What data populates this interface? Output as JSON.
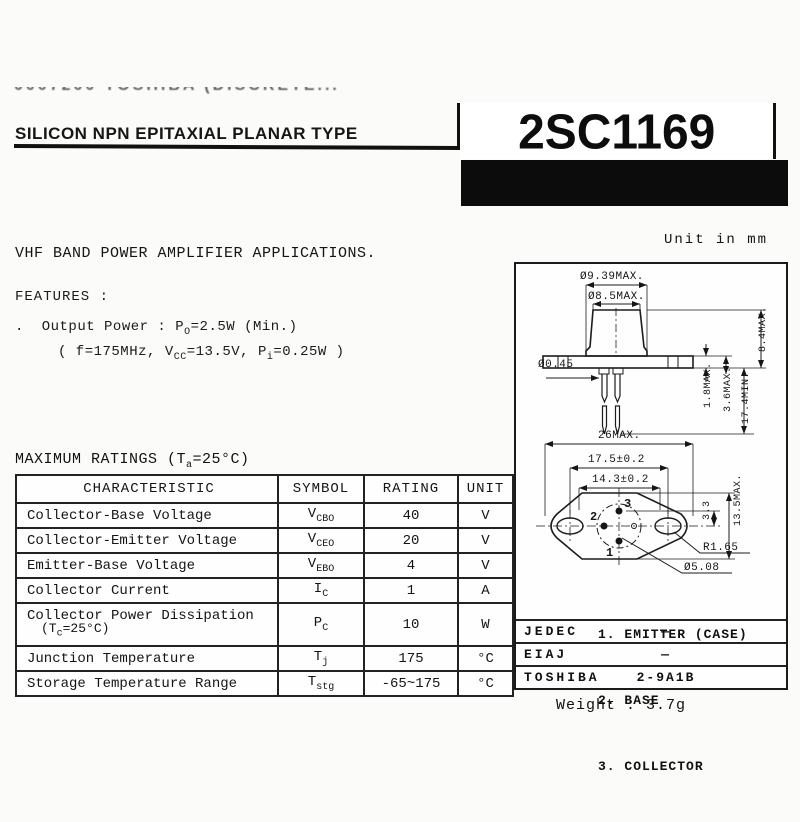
{
  "header": {
    "faded_top_line": "0007200 TOSHIBA (DISCRETE...",
    "type_line": "SILICON NPN EPITAXIAL PLANAR TYPE",
    "part_number": "2SC1169"
  },
  "application": "VHF BAND POWER AMPLIFIER APPLICATIONS.",
  "features": {
    "heading": "FEATURES :",
    "bullet": ".",
    "output_power_pre": "Output Power :  P",
    "output_power_sub": "O",
    "output_power_post": "=2.5W (Min.)",
    "cond_pre": "( f=175MHz, V",
    "cond_sub1": "CC",
    "cond_mid": "=13.5V, P",
    "cond_sub2": "i",
    "cond_post": "=0.25W )"
  },
  "max_ratings": {
    "title_pre": "MAXIMUM RATINGS (T",
    "title_sub": "a",
    "title_post": "=25°C)",
    "columns": [
      "CHARACTERISTIC",
      "SYMBOL",
      "RATING",
      "UNIT"
    ],
    "rows": [
      {
        "characteristic": "Collector-Base Voltage",
        "symbol_base": "V",
        "symbol_sub": "CBO",
        "rating": "40",
        "unit": "V"
      },
      {
        "characteristic": "Collector-Emitter Voltage",
        "symbol_base": "V",
        "symbol_sub": "CEO",
        "rating": "20",
        "unit": "V"
      },
      {
        "characteristic": "Emitter-Base Voltage",
        "symbol_base": "V",
        "symbol_sub": "EBO",
        "rating": "4",
        "unit": "V"
      },
      {
        "characteristic": "Collector Current",
        "symbol_base": "I",
        "symbol_sub": "C",
        "rating": "1",
        "unit": "A"
      },
      {
        "characteristic": "Collector Power Dissipation",
        "char2_pre": "(T",
        "char2_sub": "c",
        "char2_post": "=25°C)",
        "symbol_base": "P",
        "symbol_sub": "C",
        "rating": "10",
        "unit": "W"
      },
      {
        "characteristic": "Junction Temperature",
        "symbol_base": "T",
        "symbol_sub": "j",
        "rating": "175",
        "unit": "°C"
      },
      {
        "characteristic": "Storage Temperature Range",
        "symbol_base": "T",
        "symbol_sub": "stg",
        "rating": "-65~175",
        "unit": "°C"
      }
    ]
  },
  "outline": {
    "unit_note": "Unit in mm",
    "dimensions": {
      "cap_base_dia": "Ø9.39MAX.",
      "cap_top_dia": "Ø8.5MAX.",
      "lead_dia": "Ø0.45",
      "flange_thickness": "1.8MAX.",
      "seat_height": "3.6MAX.",
      "lead_length": "17.4MIN.",
      "cap_height": "8.4MAX.",
      "flange_width": "26MAX.",
      "hole_spacing": "17.5±0.2",
      "inner_span": "14.3±0.2",
      "pin_offset": "3.3",
      "flange_height": "13.5MAX.",
      "hole_radius": "R1.65",
      "pin_circle_dia": "Ø5.08"
    },
    "pin_numbers": {
      "p1": "1",
      "p2": "2",
      "p3": "3"
    },
    "pin_list": [
      "1. EMITTER (CASE)",
      "2. BASE",
      "3. COLLECTOR"
    ],
    "standards": [
      {
        "org": "JEDEC",
        "code": "—"
      },
      {
        "org": "EIAJ",
        "code": "—"
      },
      {
        "org": "TOSHIBA",
        "code": "2-9A1B"
      }
    ],
    "weight": "Weight : 3.7g"
  }
}
